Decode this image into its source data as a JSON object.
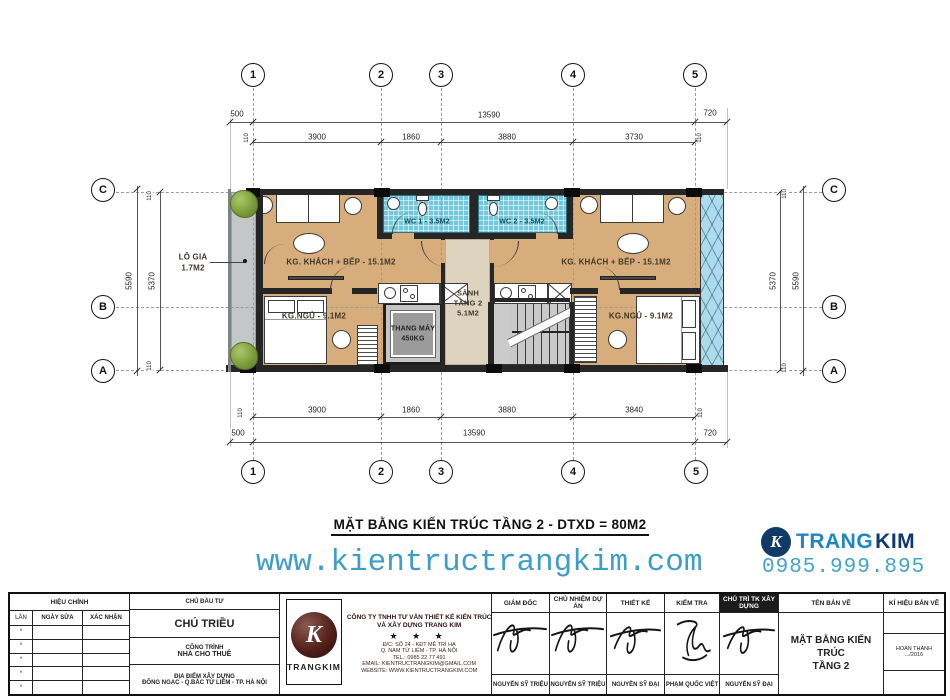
{
  "drawing_title": "MẶT BẰNG KIẾN TRÚC TẦNG 2 - DTXD = 80M2",
  "branding": {
    "website": "www.kientructrangkim.com",
    "phone": "0985.999.895",
    "brand_trang": "TRANG",
    "brand_kim": "KIM",
    "brand_icon_letter": "K",
    "accent_light_blue": "#3d9fc9",
    "accent_navy": "#113a66"
  },
  "plan": {
    "grid_cols": [
      "1",
      "2",
      "3",
      "4",
      "5"
    ],
    "grid_rows": [
      "C",
      "B",
      "A"
    ],
    "dims": {
      "top_left": "500",
      "top_overall": "13590",
      "top_right": "720",
      "top_segments": [
        "3900",
        "1860",
        "3880",
        "3730"
      ],
      "bottom_segments": [
        "3900",
        "1860",
        "3880",
        "3840"
      ],
      "bottom_left": "500",
      "bottom_overall": "13590",
      "bottom_right": "720",
      "side_outer": "5590",
      "side_inner": "5370",
      "small": "110"
    },
    "rooms": {
      "balcony_name": "LÔ GIA",
      "balcony_area": "1.7M2",
      "living_left": "KG. KHÁCH + BẾP - 15.1M2",
      "living_right": "KG. KHÁCH + BẾP - 15.1M2",
      "wc1": "WC 1 - 3.5M2",
      "wc2": "WC 2 - 3.5M2",
      "hall_line1": "SẢNH",
      "hall_line2": "TẦNG 2",
      "hall_area": "5.1M2",
      "elevator_name": "THANG MÁY",
      "elevator_load": "450KG",
      "bedroom_left": "KG.NGỦ - 9.1M2",
      "bedroom_right": "KG.NGỦ - 9.1M2"
    }
  },
  "titleblock": {
    "revision": {
      "header": "HIỆU CHỈNH",
      "col_no": "LẦN",
      "col_date": "NGÀY SỬA",
      "col_confirm": "XÁC NHẬN",
      "row_mark": "*"
    },
    "investor": {
      "header": "CHỦ ĐẦU TƯ",
      "name": "CHÚ TRIỀU",
      "project_label": "CÔNG TRÌNH",
      "project_name": "NHÀ CHO THUÊ",
      "location_label": "ĐỊA ĐIỂM XÂY DỰNG",
      "location": "ĐÔNG NGẠC - Q.BẮC TỪ LIÊM - TP. HÀ NỘI"
    },
    "company": {
      "logo_text": "TRANGKIM",
      "logo_letter": "K",
      "name_line1": "CÔNG TY TNHH TƯ VẤN THIẾT KẾ KIẾN TRÚC",
      "name_line2": "VÀ XÂY DỰNG TRANG KIM",
      "stars": "★ ★ ★",
      "address1": "Đ/C: SỐ 24 - KĐT MỄ TRÌ HẠ",
      "address2": "Q. NAM TỪ LIÊM - TP. HÀ NỘI",
      "tel": "TEL.: 0985 22 77 491",
      "email": "EMAIL: KIENTRUCTRANGKIM@GMAIL.COM",
      "website": "WEBSITE: WWW.KIENTRUCTRANGKIM.COM"
    },
    "signatures": [
      {
        "title": "GIÁM ĐỐC",
        "name": "NGUYỄN SỸ TRIỆU"
      },
      {
        "title": "CHỦ NHIỆM DỰ ÁN",
        "name": "NGUYỄN SỸ TRIỆU"
      },
      {
        "title": "THIẾT KẾ",
        "name": "NGUYỄN SỸ ĐẠI"
      },
      {
        "title": "KIỂM TRA",
        "name": "PHẠM QUỐC VIỆT"
      },
      {
        "title": "CHỦ TRÌ TK XÂY DỰNG",
        "name": "NGUYỄN SỸ ĐẠI"
      }
    ],
    "drawing": {
      "label": "TÊN BẢN VẼ",
      "name_line1": "MẶT BẰNG KIẾN TRÚC",
      "name_line2": "TẦNG 2"
    },
    "code": {
      "label": "KÍ HIỆU BẢN VẼ",
      "status": "HOÀN THÀNH",
      "date": ".../2016"
    }
  }
}
